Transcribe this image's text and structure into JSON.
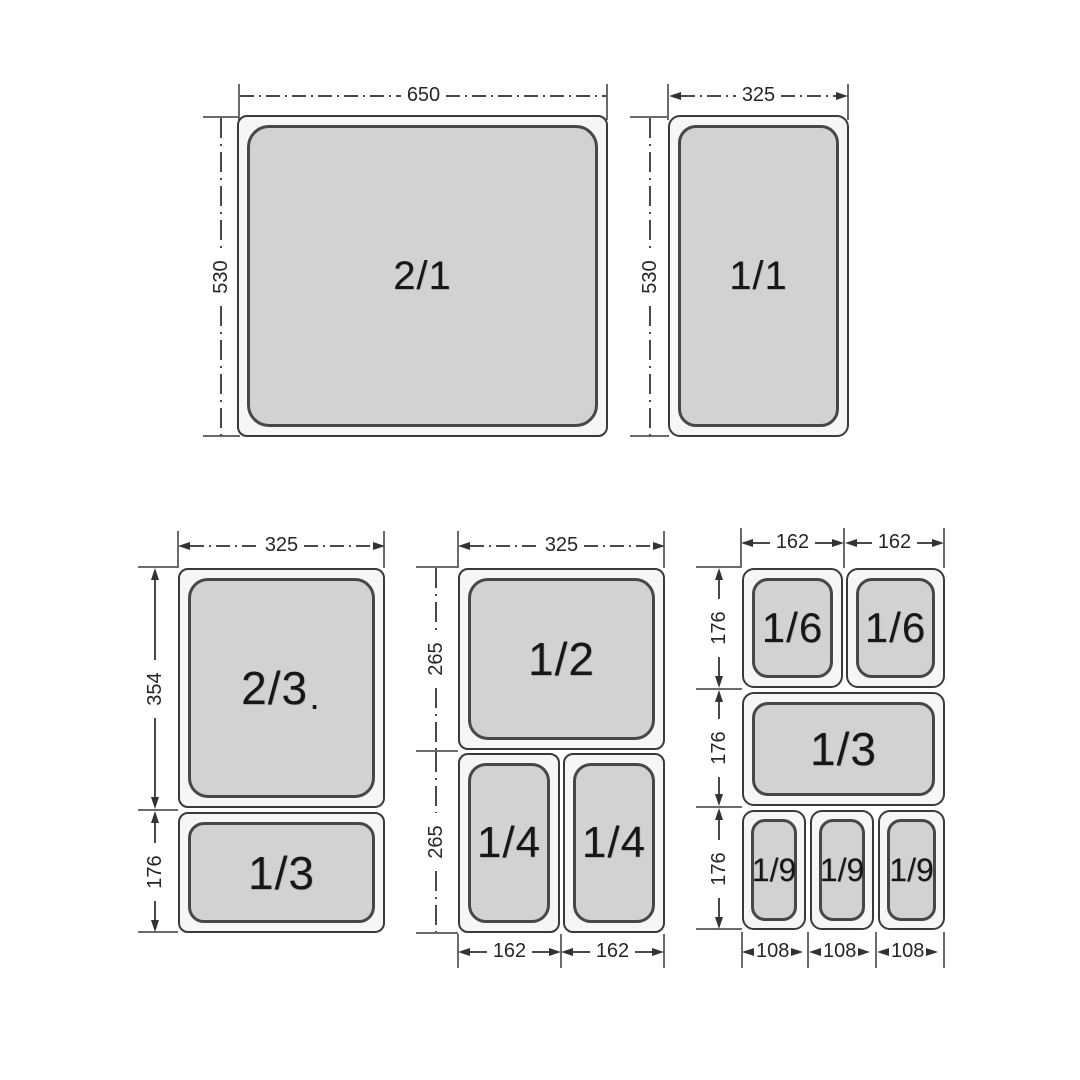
{
  "pan21": {
    "label": "2/1",
    "width": "650",
    "height": "530"
  },
  "pan11": {
    "label": "1/1",
    "width": "325",
    "height": "530"
  },
  "group_left": {
    "width": "325",
    "pan_top": {
      "label": "2/3",
      "dot": ".",
      "height": "354"
    },
    "pan_bottom": {
      "label": "1/3",
      "height": "176"
    }
  },
  "group_mid": {
    "width": "325",
    "pan_top": {
      "label": "1/2",
      "height": "265"
    },
    "row2_height": "265",
    "pan_bl": {
      "label": "1/4",
      "width": "162"
    },
    "pan_br": {
      "label": "1/4",
      "width": "162"
    }
  },
  "group_right": {
    "col_widths": [
      "162",
      "162"
    ],
    "row1": {
      "height": "176",
      "pan_left": {
        "label": "1/6"
      },
      "pan_right": {
        "label": "1/6"
      }
    },
    "row2": {
      "height": "176",
      "pan": {
        "label": "1/3"
      }
    },
    "row3": {
      "height": "176",
      "pans": [
        {
          "label": "1/9",
          "width": "108"
        },
        {
          "label": "1/9",
          "width": "108"
        },
        {
          "label": "1/9",
          "width": "108"
        }
      ]
    }
  },
  "colors": {
    "pan_fill": "#d2d2d2",
    "pan_rim": "#f6f6f6",
    "line": "#3a3a3a",
    "background": "#ffffff"
  }
}
